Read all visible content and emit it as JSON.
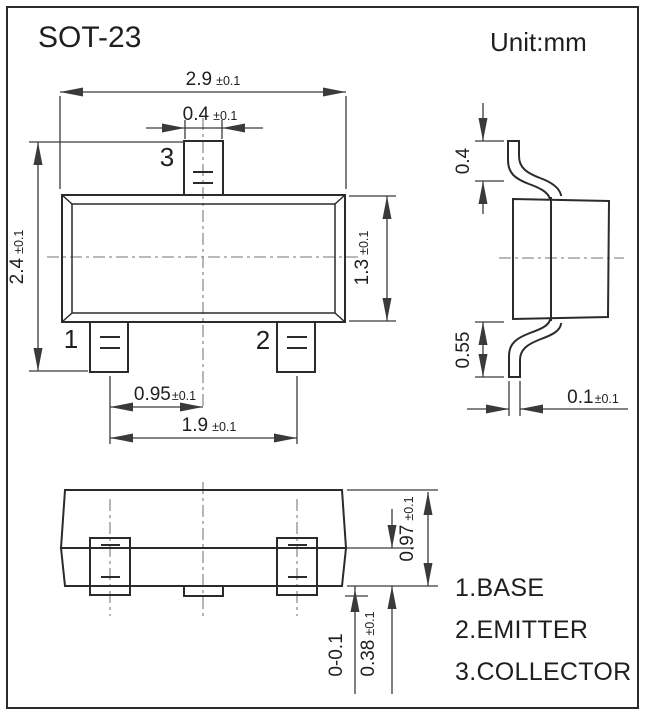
{
  "title": "SOT-23",
  "unit_label": "Unit:mm",
  "front_view": {
    "pin_labels": {
      "p1": "1",
      "p2": "2",
      "p3": "3"
    },
    "dim_body_width": {
      "value": "2.9",
      "tol": "±0.1"
    },
    "dim_lead_width": {
      "value": "0.4",
      "tol": "±0.1"
    },
    "dim_body_height": {
      "value": "2.4",
      "tol": "±0.1"
    },
    "dim_body_depth": {
      "value": "1.3",
      "tol": "±0.1"
    },
    "dim_lead_pitch": {
      "value": "0.95",
      "tol": "±0.1"
    },
    "dim_lead_span": {
      "value": "1.9",
      "tol": "±0.1"
    }
  },
  "side_view": {
    "dim_lead_top": {
      "value": "0.4",
      "tol": ""
    },
    "dim_lead_bottom": {
      "value": "0.55",
      "tol": ""
    },
    "dim_lead_thickness": {
      "value": "0.1",
      "tol": "±0.1"
    }
  },
  "bottom_view": {
    "dim_height": {
      "value": "0.97",
      "tol": "±0.1"
    },
    "dim_pad_length": {
      "value": "0.38",
      "tol": "±0.1"
    },
    "dim_protrusion": {
      "value": "0-0.1",
      "tol": ""
    }
  },
  "legend": {
    "items": [
      {
        "label": "1.BASE"
      },
      {
        "label": "2.EMITTER"
      },
      {
        "label": "3.COLLECTOR"
      }
    ]
  },
  "colors": {
    "line": "#2b2b2b",
    "text": "#1f1f1f",
    "centerline": "#8f8f8f",
    "background": "#ffffff"
  }
}
